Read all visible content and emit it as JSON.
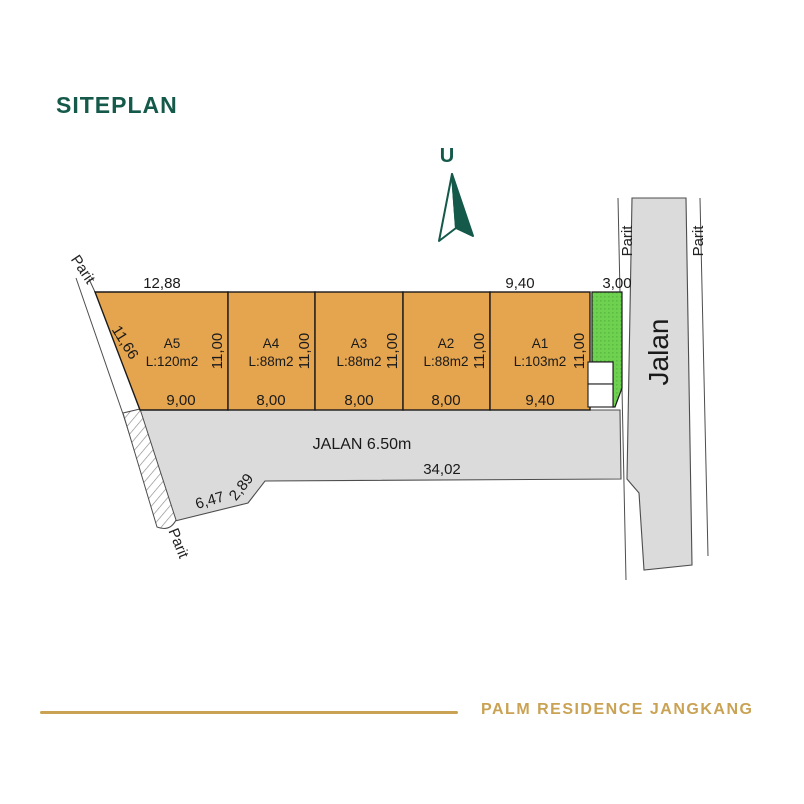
{
  "header": {
    "title": "SITEPLAN"
  },
  "labels": {
    "north": "U",
    "jalan": "Jalan",
    "road_width": "JALAN 6.50m",
    "parit": "Parit"
  },
  "plots": [
    {
      "id": "A5",
      "area": "L:120m2",
      "width": "9,00",
      "depth": "11,00"
    },
    {
      "id": "A4",
      "area": "L:88m2",
      "width": "8,00",
      "depth": "11,00"
    },
    {
      "id": "A3",
      "area": "L:88m2",
      "width": "8,00",
      "depth": "11,00"
    },
    {
      "id": "A2",
      "area": "L:88m2",
      "width": "8,00",
      "depth": "11,00"
    },
    {
      "id": "A1",
      "area": "L:103m2",
      "width": "9,40",
      "depth": "11,00"
    }
  ],
  "dimensions": {
    "top_a5": "12,88",
    "top_a1": "9,40",
    "green_width": "3,00",
    "left_edge": "11,66",
    "road_frontage": "34,02",
    "corner_long": "6,47",
    "corner_short": "2,89"
  },
  "footer": {
    "title": "PALM RESIDENCE JANGKANG"
  },
  "colors": {
    "brand_green": "#14594a",
    "gold": "#c9a254",
    "plot_fill": "#e5a44e",
    "green_area": "#6ed150",
    "road_fill": "#dbdbdb"
  }
}
